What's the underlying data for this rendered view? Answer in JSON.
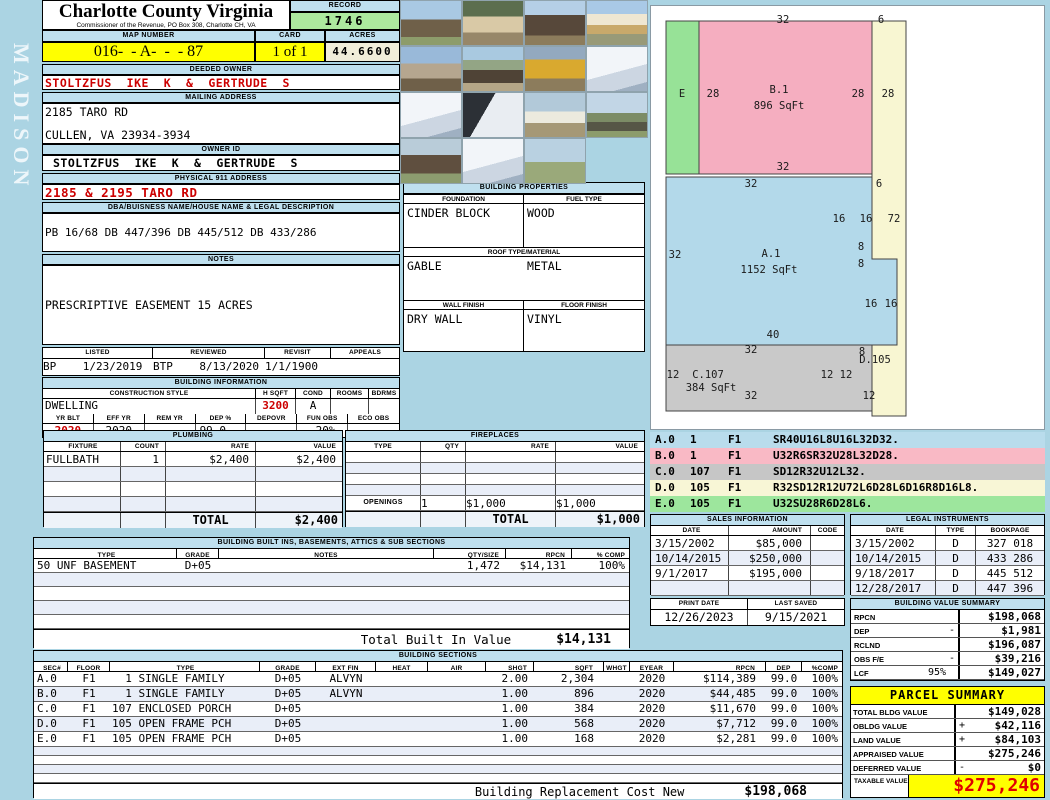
{
  "colors": {
    "page_background": "#abd4e3",
    "header_bar_blue": "#bfe0ef",
    "highlight_yellow": "#ffff00",
    "record_green": "#ace99e",
    "acres_cream": "#f1edd9",
    "alert_red": "#cc0000",
    "taxable_red": "#e00000"
  },
  "page": {
    "watermark": "MADISON"
  },
  "header": {
    "title": "Charlotte County Virginia",
    "subtitle": "Commissioner of the Revenue, PO Box 308, Charlotte CH, VA",
    "record_label": "RECORD",
    "record_value": "1746",
    "map_label": "MAP NUMBER",
    "map_value": "016-  - A-  -  - 87",
    "card_label": "CARD",
    "card_value": "1 of 1",
    "acres_label": "ACRES",
    "acres_value": "44.6600"
  },
  "owner": {
    "deeded_label": "DEEDED OWNER",
    "deeded_value": "STOLTZFUS  IKE  K  &  GERTRUDE  S",
    "mailing_label": "MAILING ADDRESS",
    "mailing_line1": "2185 TARO RD",
    "mailing_line2": "CULLEN, VA 23934-3934",
    "owner_id_label": "OWNER ID",
    "owner_id_value": "STOLTZFUS  IKE  K  &  GERTRUDE  S",
    "physical_label": "PHYSICAL 911 ADDRESS",
    "physical_value": "2185 & 2195 TARO RD",
    "dba_label": "DBA/BUISNESS NAME/HOUSE NAME & LEGAL DESCRIPTION",
    "dba_value": "PB 16/68 DB 447/396 DB 445/512 DB 433/286"
  },
  "notes": {
    "title": "NOTES",
    "lines": [
      "PRESCRIPTIVE EASEMENT 15 ACRES",
      "PLANTED 1997, BALANCE PLANTED PINE 2015",
      "(RCW 6/19) 14X60 SWMH PERSONAL PROPERTY",
      "OWNER GAVE SIZE DID NOT WANT BTP ON PROP",
      "BTP-8/13/20 DWLG COMPLETE-JH 08/13/2021"
    ]
  },
  "visits": {
    "headers": [
      "LISTED",
      "REVIEWED",
      "REVISIT",
      "APPEALS"
    ],
    "rows": [
      [
        "BP    1/23/2019",
        "BTP    8/13/2020",
        "1/1/1900",
        ""
      ]
    ]
  },
  "building_information": {
    "title": "BUILDING INFORMATION",
    "row1_headers": [
      "CONSTRUCTION STYLE",
      "H SQFT",
      "COND",
      "ROOMS",
      "BDRMS"
    ],
    "style": "DWELLING",
    "h_sqft": "3200",
    "cond": "A",
    "rooms": "",
    "bdrms": "",
    "row2_headers": [
      "YR BLT",
      "EFF YR",
      "REM YR",
      "DEP %",
      "DEPOVR",
      "FUN OBS",
      "ECO OBS"
    ],
    "yr_blt": "2020",
    "eff_yr": "2020",
    "rem_yr": "",
    "dep_pct": "99.0",
    "depovr": "",
    "fun_obs": "-20%",
    "eco_obs": ""
  },
  "plumbing": {
    "title": "PLUMBING",
    "headers": [
      "FIXTURE",
      "COUNT",
      "RATE",
      "VALUE"
    ],
    "rows": [
      [
        "FULLBATH",
        "1",
        "$2,400",
        "$2,400"
      ]
    ],
    "total_label": "TOTAL",
    "total_value": "$2,400"
  },
  "building_properties": {
    "title": "BUILDING PROPERTIES",
    "foundation_label": "FOUNDATION",
    "fuel_label": "FUEL TYPE",
    "foundation": "CINDER BLOCK",
    "fuel": "WOOD",
    "roof_label": "ROOF TYPE/MATERIAL",
    "roof_type": "GABLE",
    "roof_material": "METAL",
    "wall_label": "WALL FINISH",
    "floor_label": "FLOOR FINISH",
    "wall": "DRY WALL",
    "floor": "VINYL"
  },
  "fireplaces": {
    "title": "FIREPLACES",
    "headers": [
      "TYPE",
      "QTY",
      "RATE",
      "VALUE"
    ],
    "rows": [],
    "openings_label": "OPENINGS",
    "openings_qty": "1",
    "openings_rate": "$1,000",
    "openings_value": "$1,000",
    "total_label": "TOTAL",
    "total_value": "$1,000"
  },
  "built_ins": {
    "title": "BUILDING BUILT INS, BASEMENTS, ATTICS & SUB SECTIONS",
    "headers": [
      "TYPE",
      "GRADE",
      "NOTES",
      "QTY/SIZE",
      "RPCN",
      "% COMP"
    ],
    "rows": [
      [
        "50 UNF BASEMENT",
        "D+05",
        "",
        "1,472",
        "$14,131",
        "100%"
      ]
    ],
    "total_label": "Total Built In Value",
    "total_value": "$14,131"
  },
  "photos": {
    "items": [
      "house-rear",
      "shed",
      "barn-construction",
      "house-framing",
      "farmhouse",
      "open-shed",
      "excavator",
      "sketch-notes",
      "sketch-notes",
      "sketch-notes-dark",
      "canopy-tent",
      "field-barn",
      "pole-barn",
      "sketch-notes",
      "field"
    ]
  },
  "sketch": {
    "shapes": [
      {
        "name": "section-E",
        "type": "rect",
        "x": 15,
        "y": 15,
        "w": 33,
        "h": 153,
        "fill": "#97e297"
      },
      {
        "name": "section-B1",
        "type": "rect",
        "x": 48,
        "y": 15,
        "w": 173,
        "h": 153,
        "fill": "#f5aec0"
      },
      {
        "name": "section-D105",
        "type": "rect",
        "x": 221,
        "y": 15,
        "w": 34,
        "h": 395,
        "fill": "#f8f6d2"
      },
      {
        "name": "section-A1",
        "type": "polygon",
        "points": "15,171 221,171 221,253 246,253 246,339 15,339",
        "fill": "#b3d9ea"
      },
      {
        "name": "section-C107",
        "type": "rect",
        "x": 15,
        "y": 339,
        "w": 206,
        "h": 66,
        "fill": "#c9c9c9"
      }
    ],
    "labels": [
      {
        "x": 132,
        "y": 14,
        "t": "32"
      },
      {
        "x": 230,
        "y": 14,
        "t": "6"
      },
      {
        "x": 31,
        "y": 88,
        "t": "E"
      },
      {
        "x": 62,
        "y": 88,
        "t": "28"
      },
      {
        "x": 128,
        "y": 84,
        "t": "B.1"
      },
      {
        "x": 128,
        "y": 100,
        "t": "896 SqFt"
      },
      {
        "x": 207,
        "y": 88,
        "t": "28"
      },
      {
        "x": 237,
        "y": 88,
        "t": "28"
      },
      {
        "x": 132,
        "y": 161,
        "t": "32"
      },
      {
        "x": 100,
        "y": 178,
        "t": "32"
      },
      {
        "x": 228,
        "y": 178,
        "t": "6"
      },
      {
        "x": 188,
        "y": 213,
        "t": "16"
      },
      {
        "x": 215,
        "y": 213,
        "t": "16"
      },
      {
        "x": 243,
        "y": 213,
        "t": "72"
      },
      {
        "x": 210,
        "y": 241,
        "t": "8"
      },
      {
        "x": 210,
        "y": 258,
        "t": "8"
      },
      {
        "x": 24,
        "y": 249,
        "t": "32"
      },
      {
        "x": 120,
        "y": 248,
        "t": "A.1"
      },
      {
        "x": 118,
        "y": 264,
        "t": "1152 SqFt"
      },
      {
        "x": 220,
        "y": 298,
        "t": "16"
      },
      {
        "x": 240,
        "y": 298,
        "t": "16"
      },
      {
        "x": 122,
        "y": 329,
        "t": "40"
      },
      {
        "x": 100,
        "y": 344,
        "t": "32"
      },
      {
        "x": 211,
        "y": 346,
        "t": "8"
      },
      {
        "x": 224,
        "y": 354,
        "t": "D.105"
      },
      {
        "x": 22,
        "y": 369,
        "t": "12"
      },
      {
        "x": 57,
        "y": 369,
        "t": "C.107"
      },
      {
        "x": 176,
        "y": 369,
        "t": "12"
      },
      {
        "x": 195,
        "y": 369,
        "t": "12"
      },
      {
        "x": 60,
        "y": 382,
        "t": "384 SqFt"
      },
      {
        "x": 100,
        "y": 390,
        "t": "32"
      },
      {
        "x": 218,
        "y": 390,
        "t": "12"
      }
    ]
  },
  "legend": {
    "rows": [
      [
        "A.0",
        "1",
        "F1",
        "SR40U16L8U16L32D32."
      ],
      [
        "B.0",
        "1",
        "F1",
        "U32R6SR32U28L32D28."
      ],
      [
        "C.0",
        "107",
        "F1",
        "SD12R32U12L32."
      ],
      [
        "D.0",
        "105",
        "F1",
        "R32SD12R12U72L6D28L6D16R8D16L8."
      ],
      [
        "E.0",
        "105",
        "F1",
        "U32SU28R6D28L6."
      ]
    ],
    "colors": [
      "#b9dcec",
      "#f9b9c5",
      "#c6c6c6",
      "#f8f6d6",
      "#9de69d"
    ]
  },
  "sales": {
    "title": "SALES INFORMATION",
    "headers": [
      "DATE",
      "AMOUNT",
      "CODE"
    ],
    "rows": [
      [
        "3/15/2002",
        "$85,000",
        ""
      ],
      [
        "10/14/2015",
        "$250,000",
        ""
      ],
      [
        "9/1/2017",
        "$195,000",
        ""
      ]
    ]
  },
  "legal": {
    "title": "LEGAL INSTRUMENTS",
    "headers": [
      "DATE",
      "TYPE",
      "BOOKPAGE"
    ],
    "rows": [
      [
        "3/15/2002",
        "D",
        "327 018"
      ],
      [
        "10/14/2015",
        "D",
        "433 286"
      ],
      [
        "9/18/2017",
        "D",
        "445 512"
      ],
      [
        "12/28/2017",
        "D",
        "447 396"
      ]
    ]
  },
  "print_info": {
    "print_label": "PRINT DATE",
    "print_value": "12/26/2023",
    "saved_label": "LAST SAVED",
    "saved_value": "9/15/2021"
  },
  "bvs": {
    "title": "BUILDING VALUE SUMMARY",
    "rows": [
      [
        "RPCN",
        "",
        "",
        "$198,068"
      ],
      [
        "DEP",
        "",
        "-",
        "$1,981"
      ],
      [
        "RCLND",
        "",
        "",
        "$196,087"
      ],
      [
        "OBS F/E",
        "",
        "-",
        "$39,216"
      ],
      [
        "LCF",
        "95%",
        "",
        "$149,027"
      ]
    ]
  },
  "parcel": {
    "title": "PARCEL SUMMARY",
    "rows": [
      [
        "TOTAL BLDG VALUE",
        "",
        "$149,028"
      ],
      [
        "OBLDG VALUE",
        "+",
        "$42,116"
      ],
      [
        "LAND VALUE",
        "+",
        "$84,103"
      ],
      [
        "APPRAISED VALUE",
        "",
        "$275,246"
      ],
      [
        "DEFERRED VALUE",
        "-",
        "$0"
      ]
    ],
    "taxable_label": "TAXABLE VALUE",
    "taxable_value": "$275,246"
  },
  "sections": {
    "title": "BUILDING SECTIONS",
    "headers": [
      "SEC#",
      "FLOOR",
      "TYPE",
      "GRADE",
      "EXT FIN",
      "HEAT",
      "AIR",
      "SHGT",
      "SQFT",
      "WHGT",
      "EYEAR",
      "RPCN",
      "DEP",
      "%COMP"
    ],
    "rows": [
      [
        "A.0",
        "F1",
        "  1 SINGLE FAMILY",
        "D+05",
        "ALVYN",
        "",
        "",
        "2.00",
        "2,304",
        "",
        "2020",
        "$114,389",
        "99.0",
        "100%"
      ],
      [
        "B.0",
        "F1",
        "  1 SINGLE FAMILY",
        "D+05",
        "ALVYN",
        "",
        "",
        "1.00",
        "896",
        "",
        "2020",
        "$44,485",
        "99.0",
        "100%"
      ],
      [
        "C.0",
        "F1",
        "107 ENCLOSED PORCH",
        "D+05",
        "",
        "",
        "",
        "1.00",
        "384",
        "",
        "2020",
        "$11,670",
        "99.0",
        "100%"
      ],
      [
        "D.0",
        "F1",
        "105 OPEN FRAME PCH",
        "D+05",
        "",
        "",
        "",
        "1.00",
        "568",
        "",
        "2020",
        "$7,712",
        "99.0",
        "100%"
      ],
      [
        "E.0",
        "F1",
        "105 OPEN FRAME PCH",
        "D+05",
        "",
        "",
        "",
        "1.00",
        "168",
        "",
        "2020",
        "$2,281",
        "99.0",
        "100%"
      ]
    ],
    "footer_label": "Building Replacement Cost New",
    "footer_value": "$198,068"
  }
}
